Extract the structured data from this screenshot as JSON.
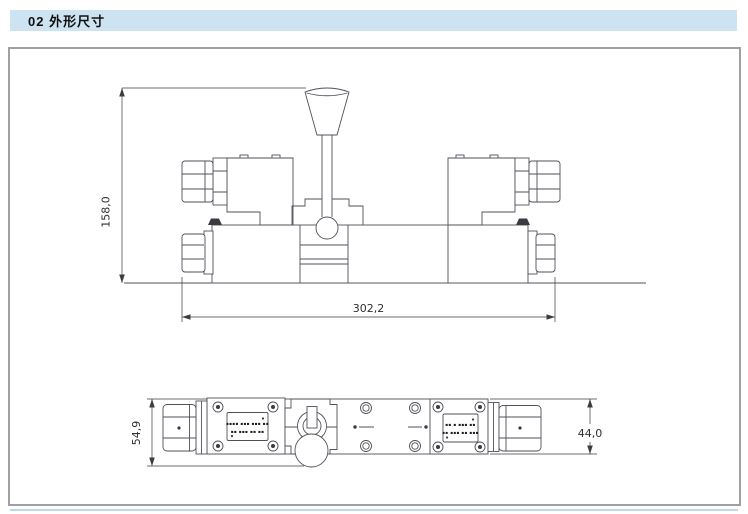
{
  "header": {
    "section_number_title": "02 外形尺寸"
  },
  "drawing": {
    "front_view": {
      "height_label": "158,0",
      "width_label": "302,2"
    },
    "bottom_view": {
      "overall_height_label": "54,9",
      "body_height_label": "44,0",
      "left_nameplate": {
        "line1": "▪▪▪▪ ▪▪▪ ▪▪▪ ▪▪",
        "line2": "▪▪ ▪▪▪ ▪▪ ▪▪"
      },
      "right_nameplate": {
        "line1": "▪▪ ▪ ▪▪▪ ▪▪",
        "line2": "▪▪ ▪▪▪ ▪▪ ▪▪▪"
      }
    }
  },
  "colors": {
    "header-bg": "#cde3f1",
    "accent-line": "#bdd8e8",
    "panel-border": "#a0a0a0",
    "line": "#50525a",
    "dim": "#3c3d42"
  }
}
